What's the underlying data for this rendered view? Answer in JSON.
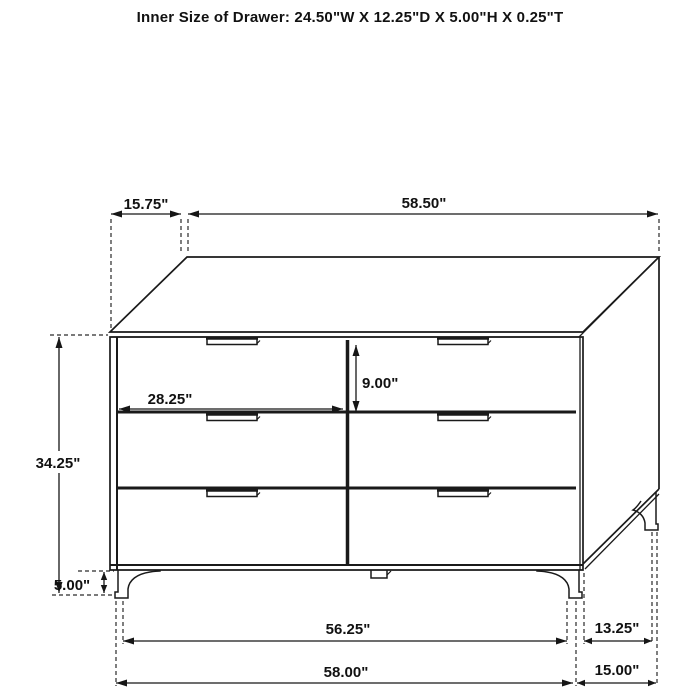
{
  "title": "Inner Size of Drawer: 24.50\"W X 12.25\"D X 5.00\"H X 0.25\"T",
  "dimensions": {
    "top_offset": "15.75\"",
    "top_width": "58.50\"",
    "overall_height": "34.25\"",
    "drawer_width": "28.25\"",
    "drawer_height": "9.00\"",
    "leg_height": "5.00\"",
    "front_span_inner": "56.25\"",
    "front_width": "58.00\"",
    "side_span": "13.25\"",
    "side_depth": "15.00\""
  },
  "furniture": {
    "kind": "six-drawer dresser",
    "drawer_rows": 3,
    "drawer_columns": 2
  },
  "colors": {
    "background": "#ffffff",
    "line": "#1a1a1a",
    "text": "#111111"
  }
}
